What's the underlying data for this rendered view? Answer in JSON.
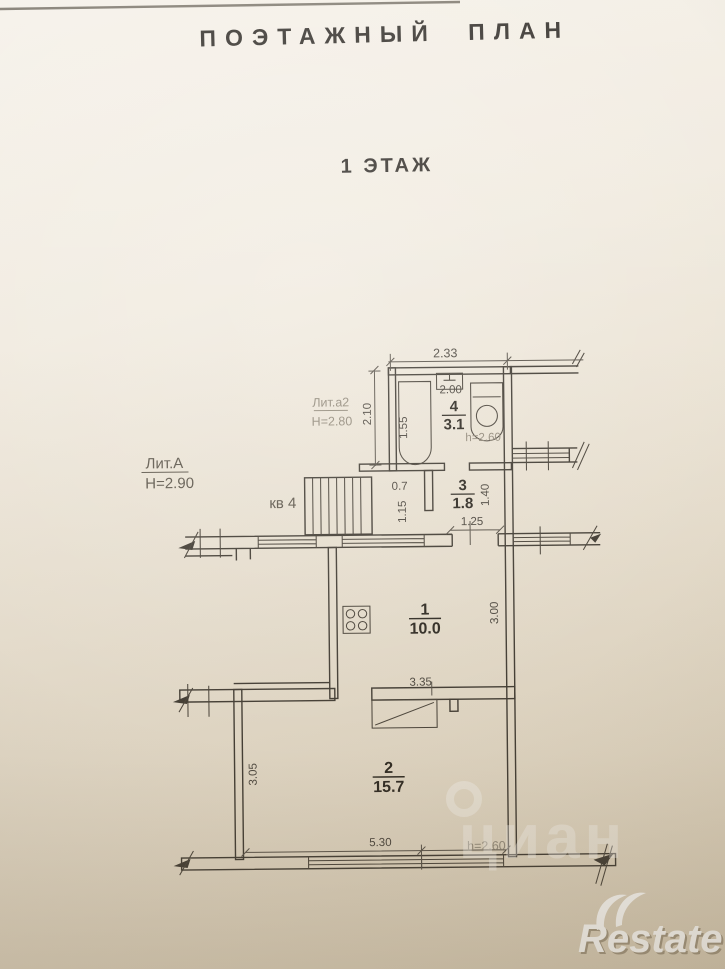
{
  "page": {
    "title": "ПОЭТАЖНЫЙ ПЛАН",
    "floor": "1 ЭТАЖ"
  },
  "labels": {
    "lit_a2": "Лит.а2",
    "lit_a2_height": "Н=2.80",
    "lit_a": "Лит.А",
    "lit_a_height": "Н=2.90",
    "apartment": "кв 4"
  },
  "rooms": {
    "r1": {
      "num": "1",
      "area": "10.0"
    },
    "r2": {
      "num": "2",
      "area": "15.7"
    },
    "r3": {
      "num": "3",
      "area": "1.8"
    },
    "r4": {
      "num": "4",
      "area": "3.1"
    }
  },
  "dims": {
    "top_width": "2.33",
    "bath_width": "2.00",
    "tub_length": "1.55",
    "left_height": "2.10",
    "bath_ceiling": "h=2.60",
    "corridor_width": "0.7",
    "corridor_depth": "1.15",
    "hall_height": "1.40",
    "hall_width": "1.25",
    "kitchen_height": "3.00",
    "kitchen_width": "3.35",
    "room2_height": "3.05",
    "room2_width": "5.30",
    "room2_ceiling": "h=2.60"
  },
  "watermarks": {
    "cian": "циан",
    "restate": "Restate"
  },
  "colors": {
    "ink": "#413c34",
    "dim_text": "#4c473f",
    "faint_text": "#938b7c",
    "paper_top": "#f5f1e9",
    "paper_bottom": "#d8ccb5"
  }
}
